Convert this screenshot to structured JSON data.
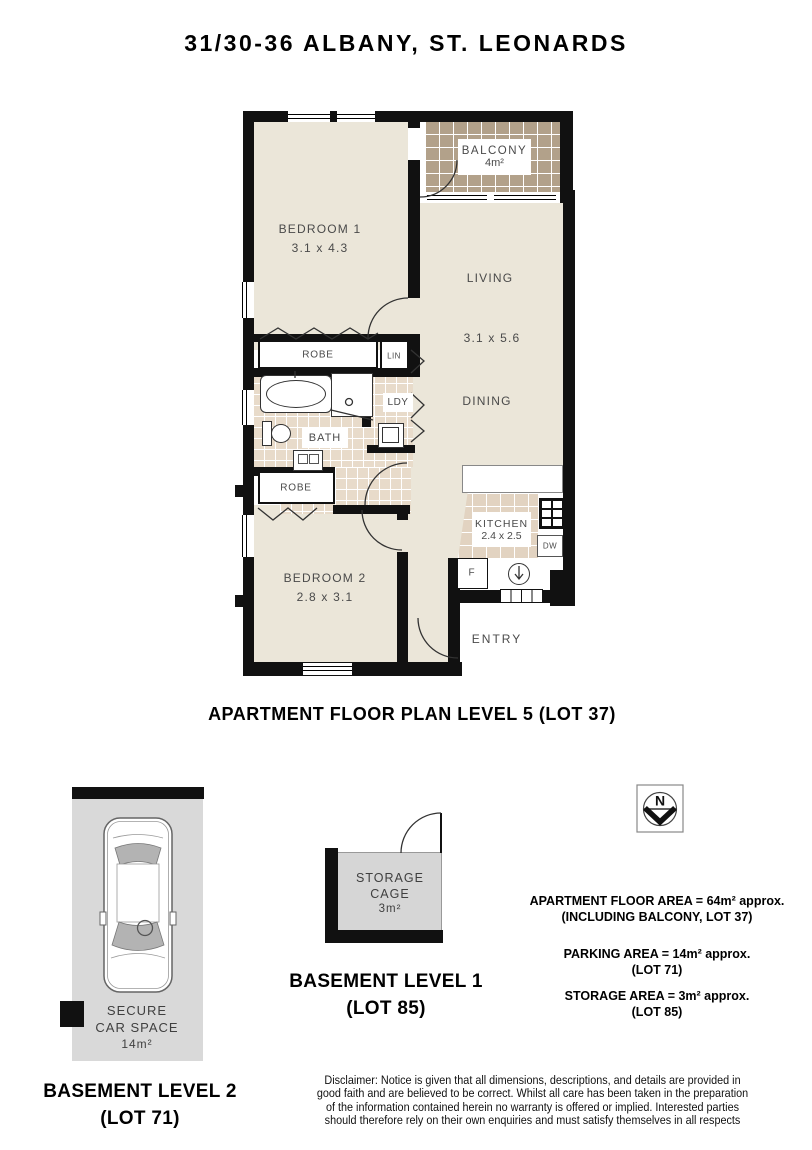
{
  "title": "31/30-36 ALBANY, ST. LEONARDS",
  "floor_plan": {
    "caption": "APARTMENT FLOOR PLAN LEVEL 5 (LOT 37)",
    "rooms": {
      "bedroom1": {
        "name": "BEDROOM 1",
        "dims": "3.1 x 4.3"
      },
      "living": {
        "name": "LIVING",
        "dims": "3.1 x 5.6"
      },
      "dining": {
        "name": "DINING"
      },
      "balcony": {
        "name": "BALCONY",
        "area": "4m²"
      },
      "bedroom2": {
        "name": "BEDROOM 2",
        "dims": "2.8 x 3.1"
      },
      "kitchen": {
        "name": "KITCHEN",
        "dims": "2.4 x 2.5"
      },
      "bath": {
        "name": "BATH"
      },
      "laundry": {
        "name": "LDY"
      },
      "robe_top": {
        "name": "ROBE"
      },
      "robe_bottom": {
        "name": "ROBE"
      },
      "linen": {
        "name": "LIN"
      },
      "entry": {
        "name": "ENTRY"
      },
      "fridge": {
        "name": "F"
      },
      "dishwasher": {
        "name": "DW"
      }
    }
  },
  "basement_level_2": {
    "space_line1": "SECURE",
    "space_line2": "CAR SPACE",
    "space_area": "14m²",
    "caption_line1": "BASEMENT LEVEL 2",
    "caption_line2": "(LOT 71)"
  },
  "basement_level_1": {
    "cage_line1": "STORAGE",
    "cage_line2": "CAGE",
    "cage_area": "3m²",
    "caption_line1": "BASEMENT LEVEL 1",
    "caption_line2": "(LOT 85)"
  },
  "compass": {
    "north_label": "N"
  },
  "area_summary": {
    "apartment_line1": "APARTMENT FLOOR AREA = 64m² approx.",
    "apartment_line2": "(INCLUDING BALCONY, LOT 37)",
    "parking_line1": "PARKING AREA = 14m² approx.",
    "parking_line2": "(LOT 71)",
    "storage_line1": "STORAGE AREA = 3m² approx.",
    "storage_line2": "(LOT 85)"
  },
  "disclaimer": {
    "line1": "Disclaimer: Notice is given that all dimensions, descriptions, and details are provided in",
    "line2": "good faith and are believed to be correct. Whilst all care has been taken in the preparation",
    "line3": "of the information contained herein no warranty is offered or implied. Interested parties",
    "line4": "should therefore rely on their own enquiries and must satisfy themselves in all respects"
  },
  "colors": {
    "wall": "#111111",
    "floor": "#ebe6d9",
    "balcony_tile": "#b2a18a",
    "bath_tile": "#e8dbca",
    "kitchen_tile": "#e2d3c1",
    "carspace_gray": "#d9d9d9",
    "storage_gray": "#d6d6d6"
  }
}
